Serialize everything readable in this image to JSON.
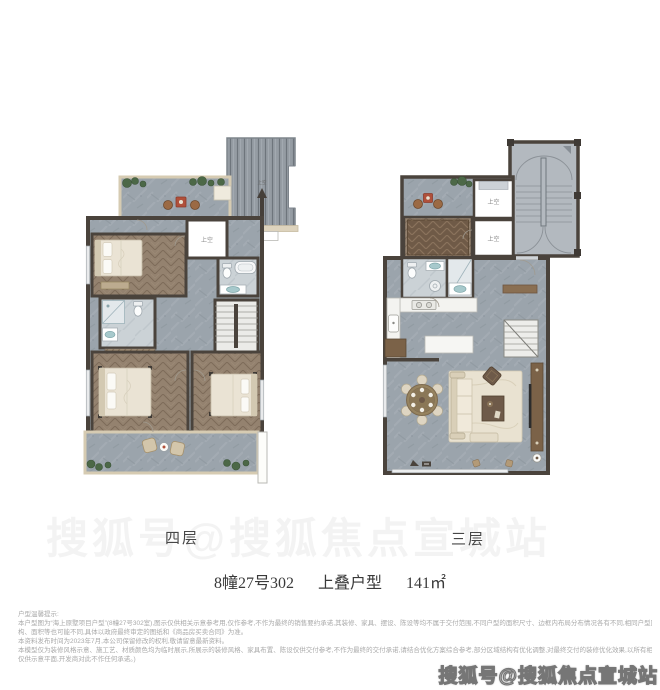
{
  "plans": {
    "floor4": {
      "label": "四层",
      "void_label": "上空",
      "roof_label": "上空"
    },
    "floor3": {
      "label": "三层",
      "void_label_1": "上空",
      "void_label_2": "上空"
    }
  },
  "title": {
    "unit": "8幢27号302",
    "type": "上叠户型",
    "area": "141㎡"
  },
  "disclaimer": {
    "heading": "户型温馨提示:",
    "lines": [
      "本户型图为“海上原墅项目户型”(8幢27号302室),图示仅供相关示意参考用,仅作参考,不作为最终的销售要约承诺,其装修、家具、摆设、陈设等均不属于交付范围,不同户型的面积尺寸、边框内布局分布情况各有不同,相同户型因楼栋、楼层、单元等差异,相邻结",
      "构、面积等也可能不同,具体以政府最终审定的图纸和《商品房买卖合同》为准。",
      "本资料发布时间为2023年7月,本公司保留修改的权利,敬请留意最新资料。",
      "本模型仅为装修风格示意、施工艺、材质颜色均为临时展示,所展示的装修风格、家具布置、陈设仅供交付参考,不作为最终的交付承诺,请结合优化方案综合参考,部分区域结构有优化调整,对最终交付的装修优化效果,以所有相关交付文件为准(模型自行判断行使权利",
      "仅供示意平面,开发商对此不作任何承诺。)"
    ]
  },
  "watermark": {
    "text": "搜狐号@搜狐焦点宣城站"
  },
  "colors": {
    "wall": "#4a433c",
    "stone": "#9ba4ac",
    "stone_light": "#cbd2d6",
    "wood": "#94826f",
    "carpet": "#6f5a47",
    "terrace_border": "#d6cbb2",
    "plant_green": "#4c6847",
    "rattan_brown": "#9b6a44",
    "table_red": "#b0503a",
    "teal_fixture": "#a7c9cc",
    "cabinet_brown": "#7b6248"
  }
}
